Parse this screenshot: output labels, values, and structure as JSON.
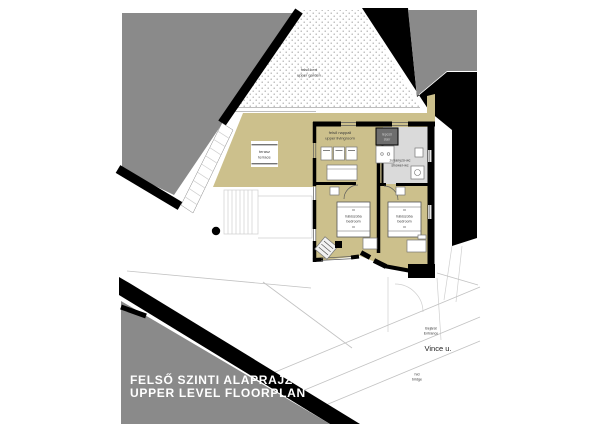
{
  "page": {
    "title_hu": "FELSŐ SZINTI ALAPRAJZ",
    "title_en": "UPPER LEVEL FLOORPLAN"
  },
  "site": {
    "garden_hu": "felső kert",
    "garden_en": "upper garden",
    "street": "Vince u.",
    "entrance_hu": "Bejárat",
    "entrance_en": "Entrance",
    "bridge_hu": "híd",
    "bridge_en": "bridge"
  },
  "rooms": {
    "terrace_hu": "terasz",
    "terrace_en": "terrace",
    "living_hu": "felső nappali",
    "living_en": "upper livingroom",
    "stair_hu": "lépcső",
    "stair_en": "stair",
    "bath_hu": "zuhanyzó-wc",
    "bath_en": "shower-wc",
    "bedroom1_hu": "hálószoba",
    "bedroom1_en": "bedroom",
    "bedroom2_hu": "hálószoba",
    "bedroom2_en": "bedroom"
  },
  "colors": {
    "floor_beige": "#ccc08c",
    "neighbor_gray": "#8a8a8a",
    "bath_gray": "#dadada",
    "stair_dark": "#6e6e6e",
    "wall_black": "#000000",
    "title_white": "#ffffff"
  }
}
